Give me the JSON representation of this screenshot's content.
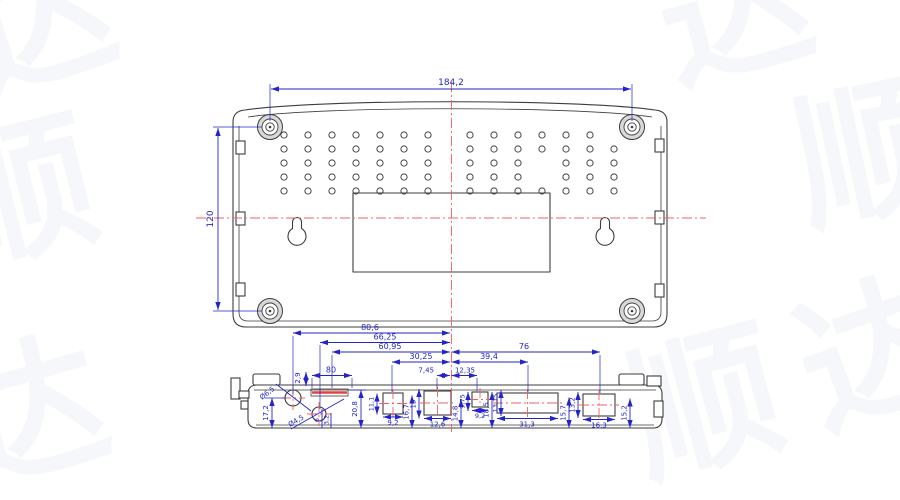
{
  "watermark": {
    "chars": [
      "顺",
      "达"
    ]
  },
  "colors": {
    "dimension_blue": "#2424cb",
    "centerline_red": "#f15f5f",
    "outline_dark": "#3d3d3d"
  },
  "top_view": {
    "dim_width": "184,2",
    "dim_height": "120"
  },
  "bottom_view": {
    "chain": {
      "d80_6": "80,6",
      "d66_25": "66,25",
      "d60_95": "60,95",
      "d30_25": "30,25",
      "d7_45": "7,45",
      "d12_35": "12,35",
      "d39_4": "39,4",
      "d76": "76",
      "d80": "80"
    },
    "verticals": {
      "d2_9": "2,9",
      "d17_2": "17,2",
      "d20_8": "20,8",
      "d11_1": "11,1",
      "d16_7": "16,7",
      "d15": "15",
      "d14_8": "14,8",
      "d9_75": "9,75",
      "d18_5": "18,5",
      "d13_15": "13,15",
      "d15_7": "15,7",
      "d13_2": "13,2",
      "d15_2": "15,2",
      "d6": "6",
      "d3_2": "3,2"
    },
    "horizontals": {
      "d9_2a": "9,2",
      "d12_6": "12,6",
      "d9_2b": "9,2",
      "d31_3": "31,3",
      "d16_3": "16,3"
    },
    "leaders": {
      "dia6_5": "Ø6,5",
      "dia4_5": "Ø4,5"
    }
  }
}
